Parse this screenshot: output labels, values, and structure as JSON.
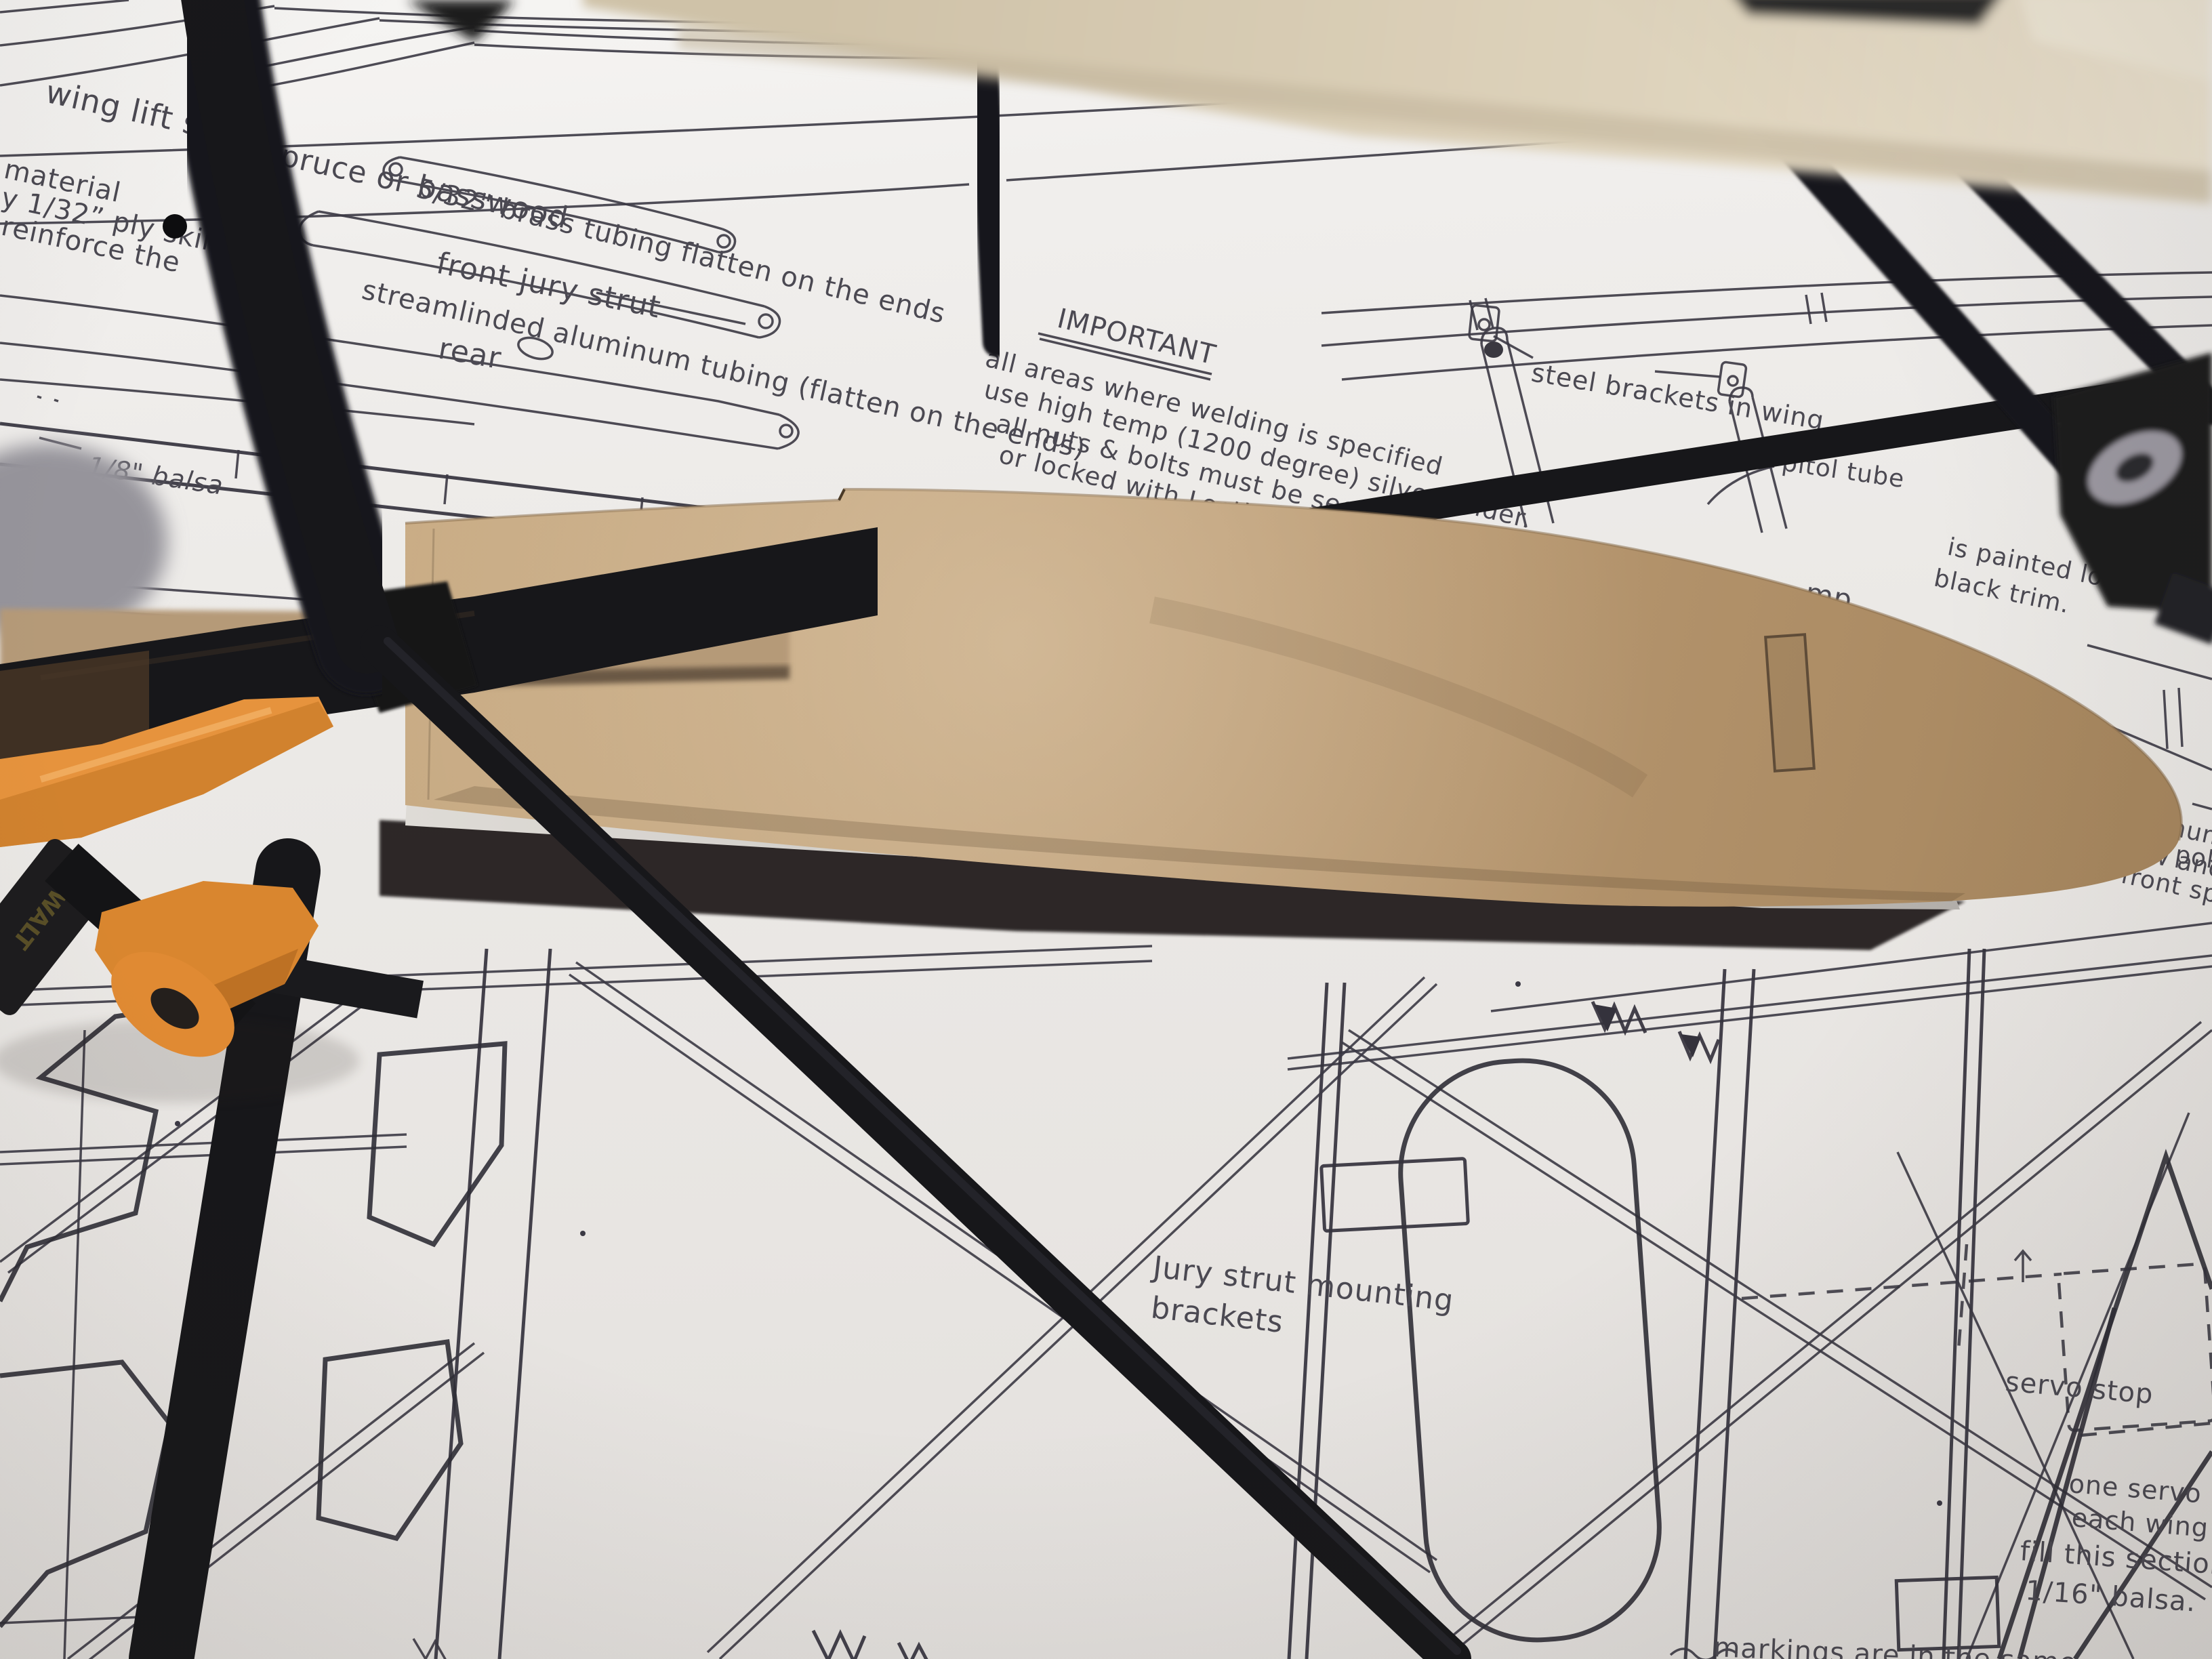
{
  "scene": {
    "objects": [
      "aircraft-blueprint-sheets",
      "steel-tube-airframe",
      "plywood-wingtip-blank",
      "bar-clamp",
      "workbench"
    ]
  },
  "plan_labels": {
    "wing_lift_strut": "wing lift strut",
    "spruce": "spruce or basswood",
    "material_1": "material",
    "material_2": "y 1/32” ply skins",
    "material_3": "reinforce the",
    "brass_tubing": "5/32\" brass tubing flatten on the ends",
    "front_jury_strut": "front jury strut",
    "streamlined": "streamlinded aluminum tubing (flatten on the ends)",
    "rear": "rear",
    "important_title": "IMPORTANT",
    "important_line1": "all areas where welding is specified",
    "important_line2": "use high temp (1200 degree) silver solder.",
    "important_line3": "all nuts & bolts must be secured",
    "important_line4": "or locked with Loctite or equivalent.",
    "steel_brackets": "steel brackets in wing",
    "pitot_tube": "pitol tube",
    "balsa_18": "1/8\" balsa",
    "front_spar": "front spar 5/16\"",
    "lock_haven_1": "is painted lock haven",
    "lock_haven_2": "black trim.",
    "mp_fragment": "mp",
    "poke_fragment": "poke",
    "aluminum_1": "aluminum plate",
    "aluminum_2": "screw and epoxy",
    "aluminum_3": "front spar",
    "jury_mounting_1": "Jury strut mounting",
    "jury_mounting_2": "brackets",
    "servo_stop": "servo stop",
    "one_servo_1": "one servo in",
    "one_servo_2": "each wing",
    "fill_section_1": "fill this section with",
    "fill_section_2": "1/16\" balsa.",
    "markings": "markings are in the same"
  },
  "clamp": {
    "brand_label": "DEWALT"
  },
  "palette": {
    "paper": "#efedeb",
    "plan_line": "#3b3944",
    "plan_text": "#4b4952",
    "tube_black": "#17171a",
    "wingtip_tan": "#b5946d",
    "beam_cream": "#ddd3bd",
    "clamp_orange": "#e6933d",
    "shadow_dark": "#241f1c",
    "metal_gray": "#c9c6c2"
  }
}
